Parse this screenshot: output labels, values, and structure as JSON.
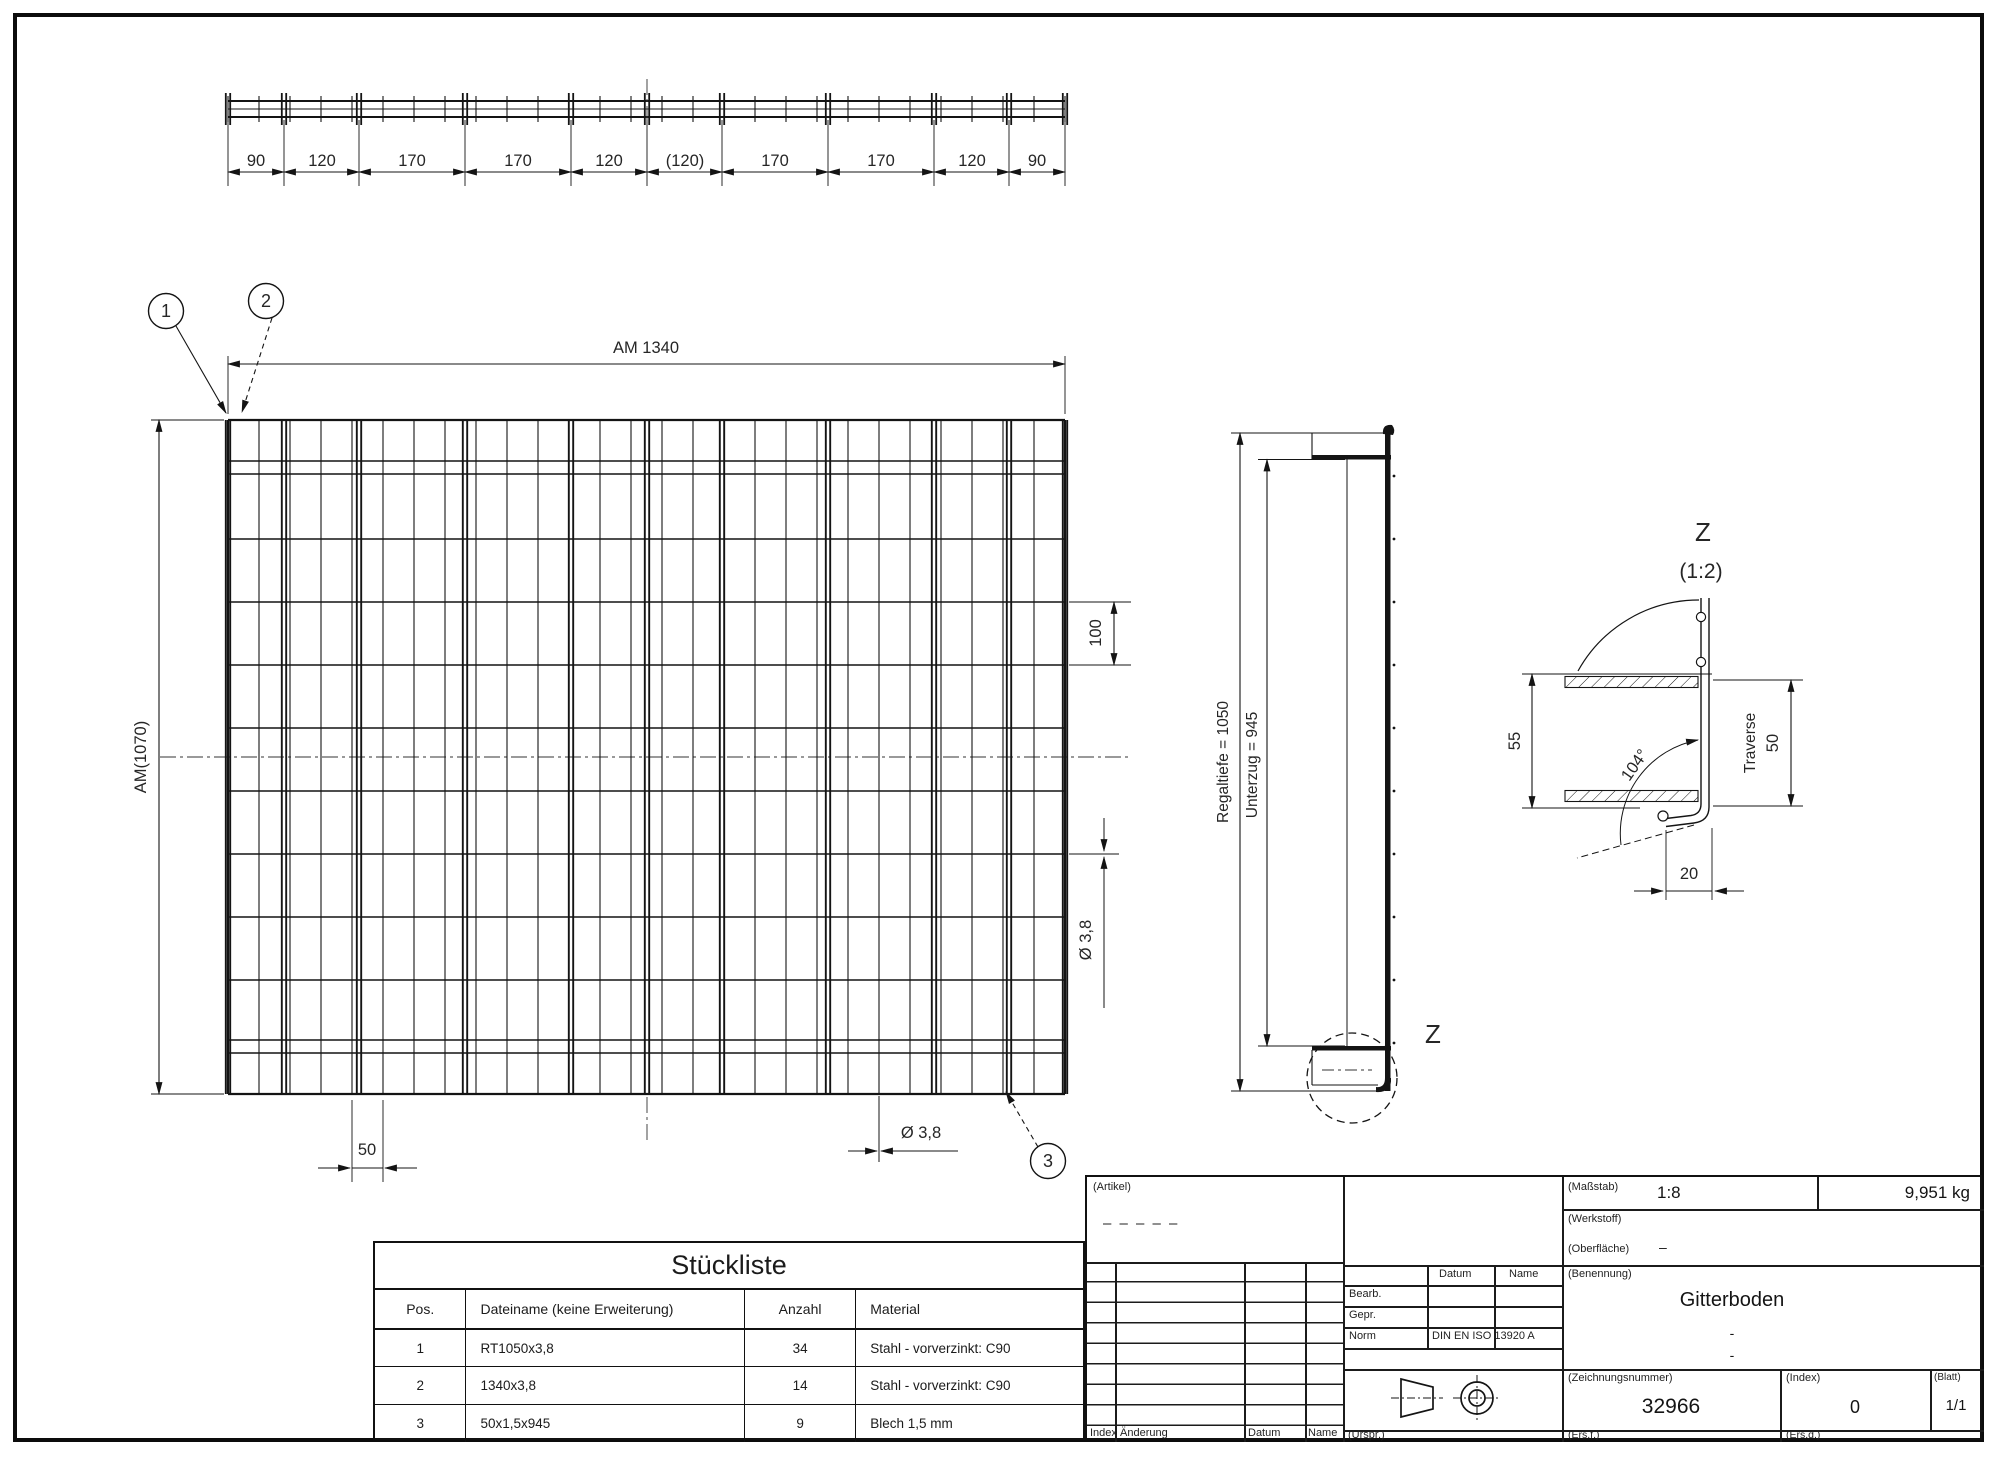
{
  "drawing": {
    "top_dim_chain": [
      "90",
      "120",
      "170",
      "170",
      "120",
      "(120)",
      "170",
      "170",
      "120",
      "90"
    ],
    "balloons": [
      "1",
      "2",
      "3"
    ],
    "plan_view": {
      "width_label": "AM 1340",
      "height_label": "AM(1070)",
      "dim_100": "100",
      "dim_wire_right": "Ø 3,8",
      "dim_50": "50",
      "dim_wire_bottom": "Ø 3,8"
    },
    "side_view": {
      "depth_label": "Regaltiefe = 1050",
      "beam_label": "Unterzug = 945",
      "detail_mark": "Z"
    },
    "detail_z": {
      "title": "Z",
      "scale": "(1:2)",
      "dim_55": "55",
      "angle": "104°",
      "traverse_label": "Traverse",
      "dim_50": "50",
      "dim_20": "20"
    }
  },
  "parts_list": {
    "title": "Stückliste",
    "columns": [
      "Pos.",
      "Dateiname (keine Erweiterung)",
      "Anzahl",
      "Material"
    ],
    "rows": [
      {
        "pos": "1",
        "name": "RT1050x3,8",
        "qty": "34",
        "material": "Stahl - vorverzinkt: C90"
      },
      {
        "pos": "2",
        "name": "1340x3,8",
        "qty": "14",
        "material": "Stahl - vorverzinkt: C90"
      },
      {
        "pos": "3",
        "name": "50x1,5x945",
        "qty": "9",
        "material": "Blech 1,5 mm"
      }
    ]
  },
  "title_block": {
    "artikel_label": "(Artikel)",
    "artikel_value": "– – – – –",
    "rev_footer": [
      "Index",
      "Änderung",
      "Datum",
      "Name"
    ],
    "urspr_label": "(Urspr.)",
    "approval": {
      "datum_header": "Datum",
      "name_header": "Name",
      "row1_label": "Bearb.",
      "row2_label": "Gepr.",
      "row3_label": "Norm",
      "row3_value": "DIN EN ISO 13920 A"
    },
    "masstab_label": "(Maßstab)",
    "masstab_value": "1:8",
    "weight": "9,951 kg",
    "werkstoff_label": "(Werkstoff)",
    "oberflaeche_label": "(Oberfläche)",
    "oberflaeche_value": "–",
    "benennung_label": "(Benennung)",
    "benennung_value": "Gitterboden",
    "benennung_sub1": "-",
    "benennung_sub2": "-",
    "zeichnungsnummer_label": "(Zeichnungsnummer)",
    "zeichnungsnummer_value": "32966",
    "index_label": "(Index)",
    "index_value": "0",
    "blatt_label": "(Blatt)",
    "blatt_value": "1/1",
    "ersf_label": "(Ers.f.)",
    "ersd_label": "(Ers.d.)"
  }
}
